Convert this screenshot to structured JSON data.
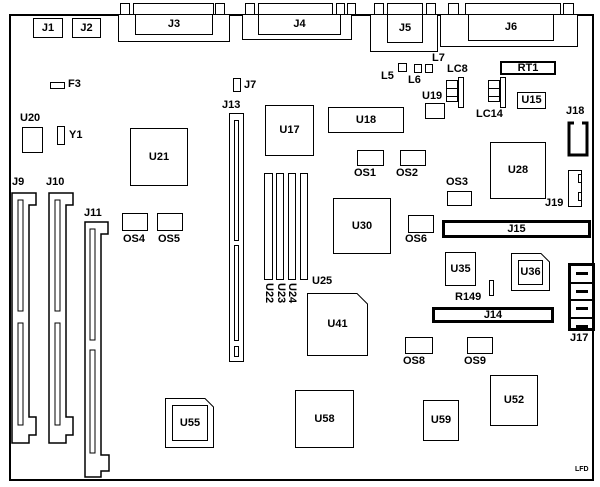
{
  "diagram": {
    "type": "motherboard-component-layout",
    "background": "#ffffff",
    "line_color": "#000000",
    "watermark": "LFD"
  },
  "labels": {
    "j1": "J1",
    "j2": "J2",
    "j3": "J3",
    "j4": "J4",
    "j5": "J5",
    "j6": "J6",
    "f3": "F3",
    "j7": "J7",
    "l5": "L5",
    "l6": "L6",
    "l7": "L7",
    "lc8": "LC8",
    "rt1": "RT1",
    "u19": "U19",
    "u15": "U15",
    "lc14": "LC14",
    "j18": "J18",
    "u20": "U20",
    "y1": "Y1",
    "u21": "U21",
    "j13": "J13",
    "u17": "U17",
    "u18": "U18",
    "u28": "U28",
    "j9": "J9",
    "j10": "J10",
    "j11": "J11",
    "os1": "OS1",
    "os2": "OS2",
    "os3": "OS3",
    "os4": "OS4",
    "os5": "OS5",
    "os6": "OS6",
    "j19": "J19",
    "u30": "U30",
    "j15": "J15",
    "u22": "U22",
    "u23": "U23",
    "u24": "U24",
    "u25": "U25",
    "u35": "U35",
    "u36": "U36",
    "r149": "R149",
    "j14": "J14",
    "u41": "U41",
    "j17": "J17",
    "os8": "OS8",
    "os9": "OS9",
    "u55": "U55",
    "u58": "U58",
    "u59": "U59",
    "u52": "U52",
    "lfd": "LFD"
  }
}
